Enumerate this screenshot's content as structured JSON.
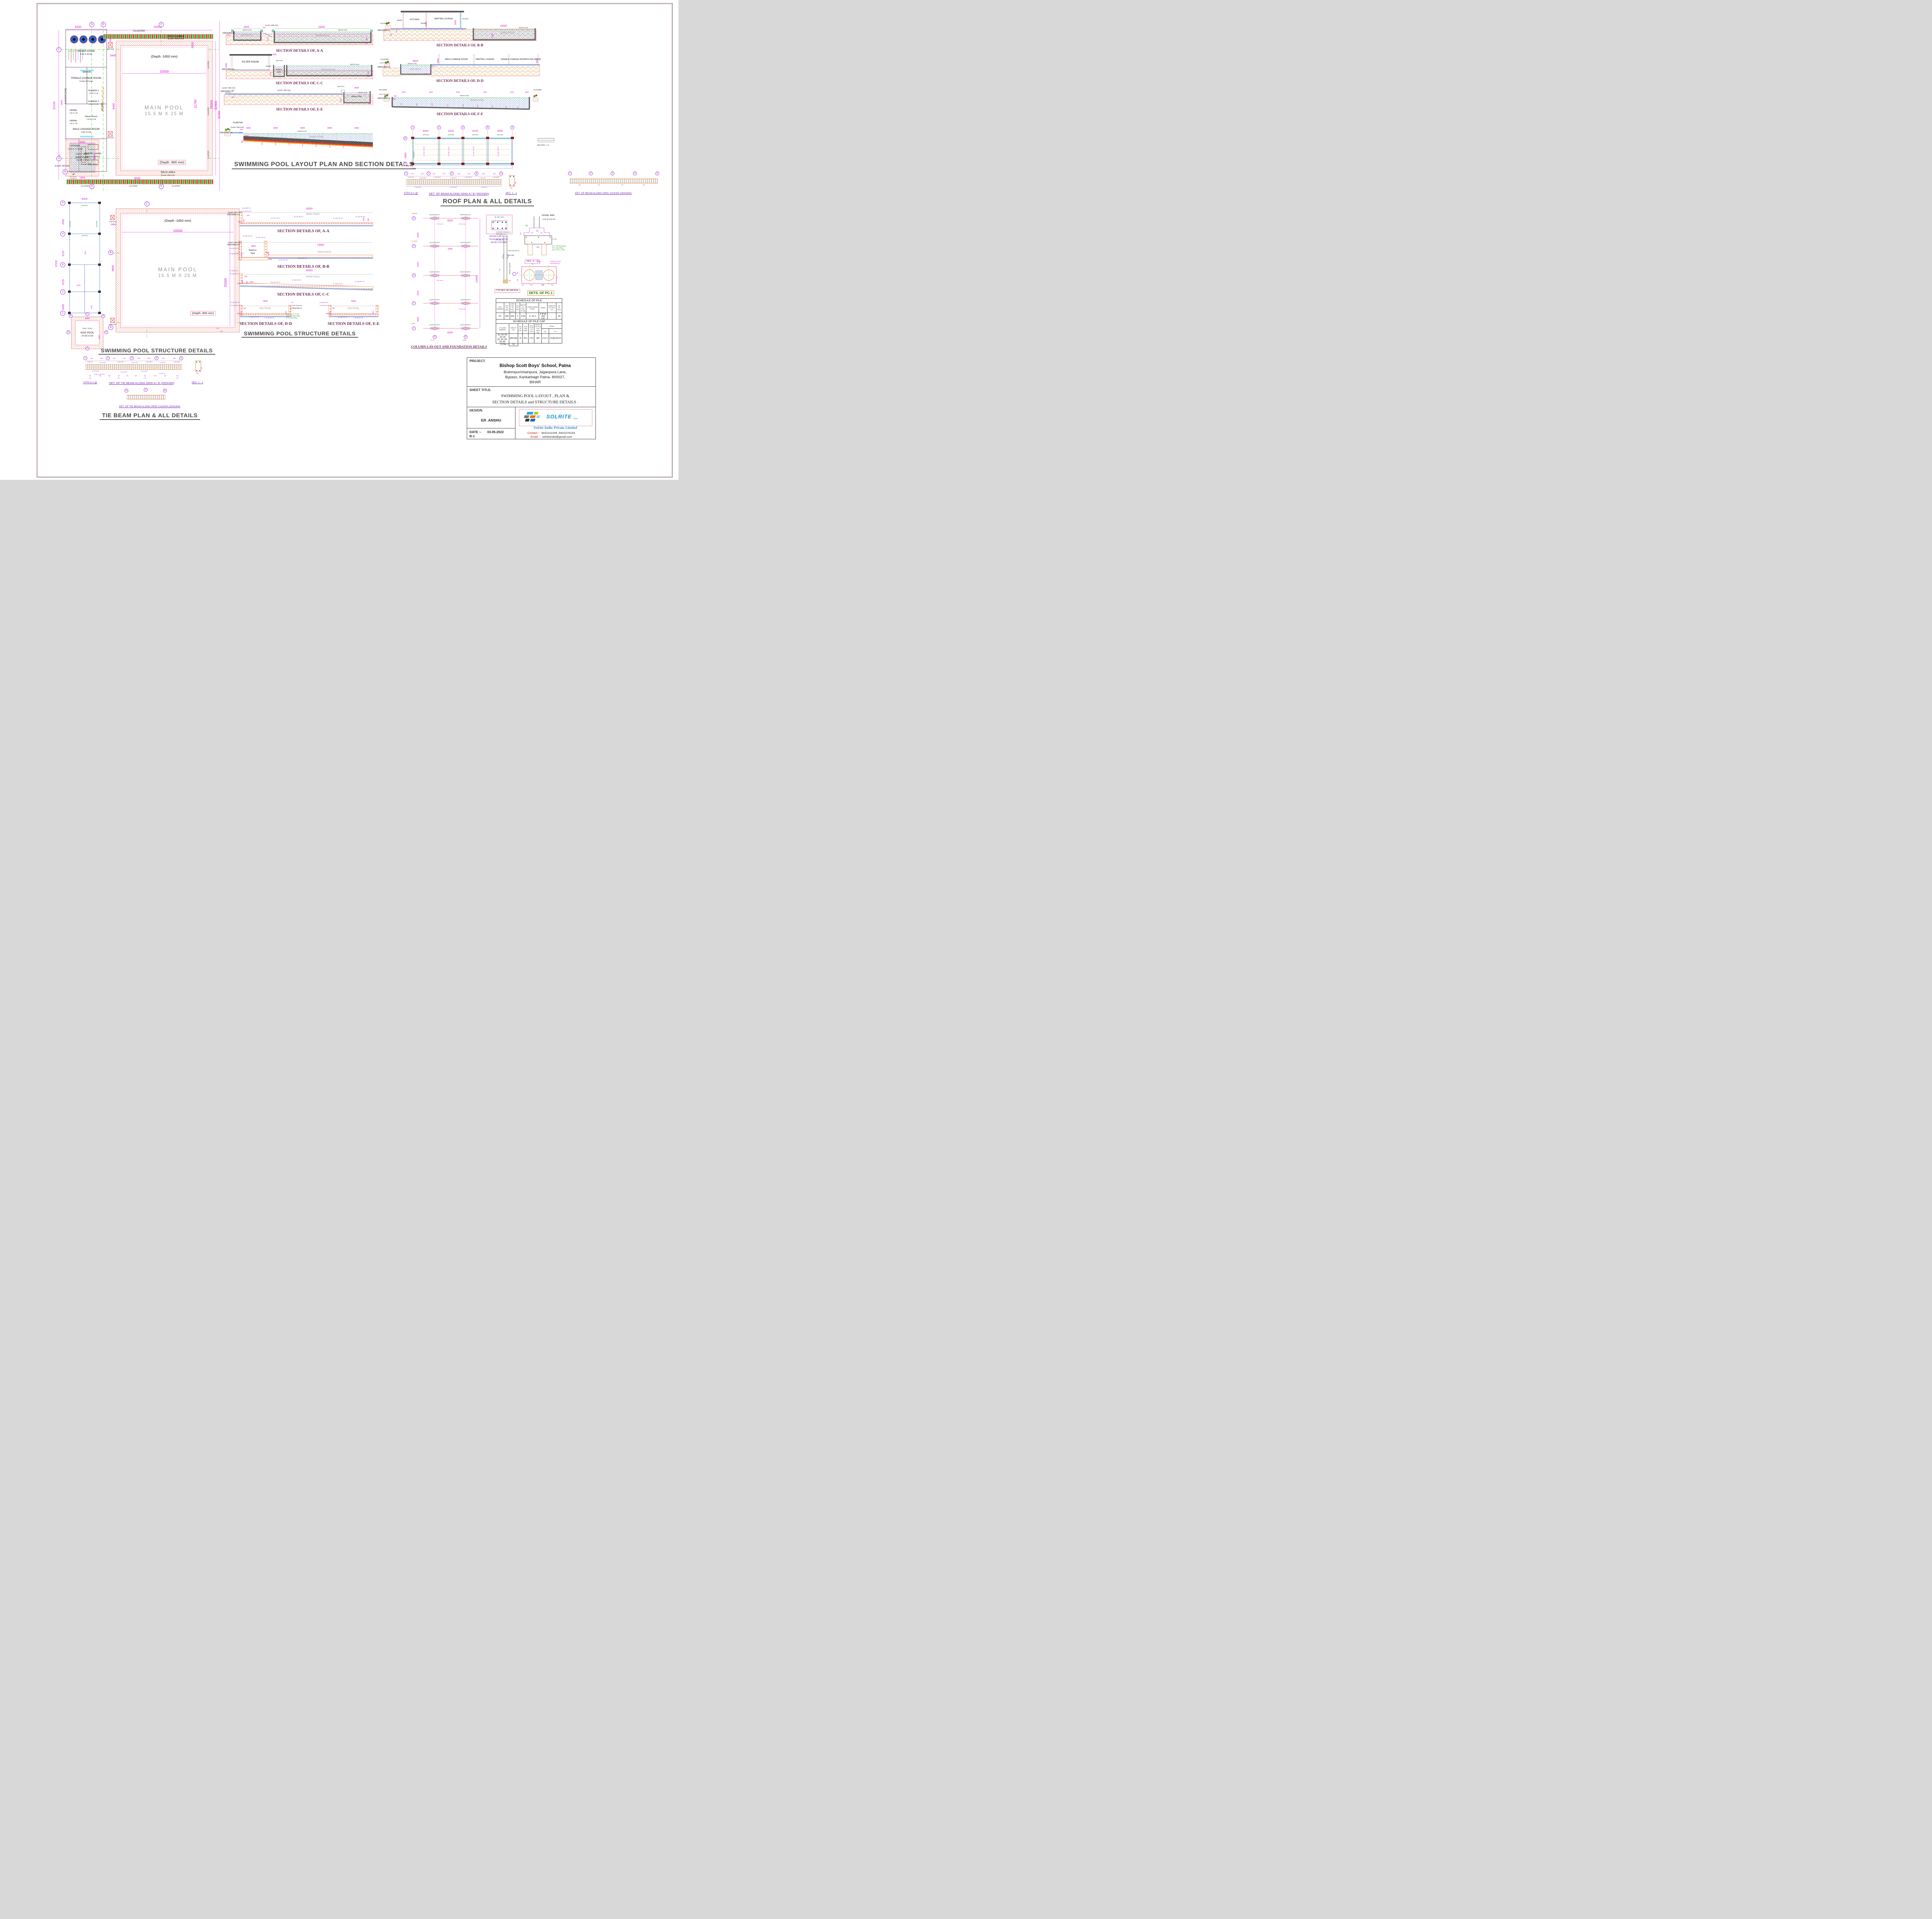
{
  "titles": {
    "layout": "SWIMMING POOL LAYOUT PLAN AND SECTION DETAILS",
    "roof": "ROOF  PLAN & ALL DETAILS",
    "structure_plan": "SWIMMING POOL STRUCTURE  DETAILS",
    "structure_sections": "SWIMMING POOL STRUCTURE  DETAILS",
    "tie": "TIE BEAM  PLAN & ALL DETAILS",
    "column": "COLUMN  LAY-OUT AND FOUNDATION DETAILS"
  },
  "plan": {
    "bub": {
      "d": "D",
      "e": "E",
      "f": "F",
      "c": "C",
      "b": "B",
      "a": "A"
    },
    "dims": {
      "d6250": "6250",
      "d22200": "22200",
      "d15500": "15500",
      "d11700": "11700",
      "d25000": "25000",
      "d32400": "32400",
      "d3000": "3000",
      "d2400": "2400",
      "d9400": "9400",
      "d1800": "1800",
      "d4500": "4500",
      "d1200": "1200",
      "d6000": "6000",
      "d22100": "22100",
      "d200": "200",
      "d300": "300"
    },
    "planter": "PLANTER",
    "plaster": "PLASTER",
    "deck": "DECK AREA",
    "lv600": "(Level +600 mm)",
    "filter": "FILTER ROOM",
    "filter_sz": "6 M X 4.5 M",
    "manhole": "MAN HOLE",
    "mirror": "MIRROR",
    "female": "FEMALE  CHANGE  ROOM",
    "female_sz": "6 mm  X  6 mm",
    "shower": "SHOWER  ZONE",
    "ch1": "CHANGE-1",
    "ch1_sz": "1.6 M X 1 M",
    "ch2": "CHANGE-2",
    "urinal": "URINAL",
    "urinal_sz": "1 M X 1 M",
    "locker": "LOCKER",
    "steam": "Steam  Room",
    "steam_sz": "1.5 M X 2 M",
    "male": "MALE  CHANGE  ROOM",
    "male_sz": "6 M X 6 M",
    "kitchen": "KITCHEN",
    "kitchen_sz": "2.275 M X 4.975 M",
    "wait": "WAITING  LOUNG",
    "wait_sz": "3.675 M X 4.975 M",
    "lv450": "(Level +450 mm)",
    "lv00": "(Level +00 mm)",
    "up": "UP",
    "main": "MAIN  POOL",
    "main_sz": "15.5  M  X  25  M",
    "depth1650": "(Depth -1650 mm)",
    "depth900": "(Depth -900 mm)",
    "kids": "KIDS POOL",
    "kids_sz": "4.5 M X 6 M",
    "depth750": "(Depth -750mm)"
  },
  "sec": {
    "gl": "GROUND LV.",
    "wl": "WATER LEVEL",
    "lv500": "(Level +500 mm)",
    "lv600": "(Level +600 mm)",
    "aa": {
      "cap": "SECTION DETAILS OF, A-A",
      "kids": "KIDS POOL",
      "main": "MAIN  POOL",
      "d4500": "4500",
      "d250": "250",
      "d15500": "15500",
      "d600": "600",
      "d750": "750",
      "d3150": "3150",
      "d900": "900",
      "d300": "300"
    },
    "cc": {
      "cap": "SECTION DETAILS OF, C-C",
      "filter": "FILTER ROOM",
      "door": "DOOR",
      "mh": "MAN HOLE",
      "bt1": "Balance",
      "bt2": "Tank",
      "main": "MAIN  POOL",
      "d3000": "3000",
      "d600": "600",
      "d1200": "1200",
      "d1650": "1650",
      "d300": "300"
    },
    "ee": {
      "cap": "SECTION DETAILS OF, E-E",
      "mh": "MAN HOLE",
      "bt": "Balance Tank",
      "d150": "150",
      "d300": "300",
      "d3600": "3600",
      "d1200": "1200",
      "d1500": "1500",
      "d32400": "32400"
    },
    "long": {
      "planter": "PLANTER",
      "main": "MAIN  POOL",
      "d3000": "3000",
      "d300": "300",
      "d200": "200",
      "d1000": "1000",
      "d900": "900",
      "depths": [
        "1515",
        "1609",
        "1715",
        "1811",
        "1898",
        "2001",
        "2114"
      ]
    },
    "bb": {
      "cap": "SECTION DETAILS OF, B-B",
      "kitchen": "KITCHEN",
      "wait": "WAITING LOUNGE",
      "door": "DOOR",
      "glass": "GLASS",
      "main": "MAIN  POOL",
      "planter": "PLANTER",
      "d2100": "2100",
      "d3000": "3000",
      "d50": "50",
      "d15500": "15500",
      "d1300": "1300",
      "d950": "950",
      "d416": "416.6"
    },
    "dd": {
      "cap": "SECTION DETAILS OF, D-D",
      "male": "MALE CHANGE ROOM",
      "wait": "WAITING LOUNGE",
      "female": "FEMALE CHANGE ROOM",
      "filter": "FILTER ROOM",
      "kids": "KIDS POOL",
      "planter": "PLANTER",
      "d4500": "4500",
      "d3000": "3000",
      "d750": "750",
      "d300": "300",
      "d200": "200"
    },
    "ff": {
      "cap": "SECTION DETAILS OF, F-F",
      "main": "MAIN  POOL",
      "planter": "PLANTER",
      "d3000": "3000",
      "d1000": "1000",
      "d300": "300",
      "d200": "200",
      "depths": [
        "900",
        "965",
        "1083",
        "1161",
        "1259",
        "1355",
        "1454",
        "1552",
        "1000"
      ]
    }
  },
  "roof": {
    "grid": [
      "1",
      "2",
      "3",
      "4",
      "5"
    ],
    "gdims": [
      "6000",
      "5226",
      "6125",
      "4500"
    ],
    "ab": [
      "A",
      "B"
    ],
    "d6000": "6000",
    "beam": "(250X450)",
    "reb1": "10 # @ 175 C/C",
    "reb2": "10 # @ 150 C/C",
    "d600": "600",
    "secaa": "SECTION - A-A",
    "det1": "DET. OF  BEAM ALONG GRID A / B  (250X400)",
    "det2": "DET. OF  BEAM ALONG GRID 1/2/3/4/5  (250X400)",
    "sec11": "SEC. 1 - 1",
    "stps": "STPS 8 # @",
    "bdims": [
      "2000",
      "2000",
      "1750",
      "1750",
      "2050",
      "2050",
      "1500",
      "1500"
    ],
    "breb": [
      "2-16 # TH.",
      "1-20 # EXT.",
      "1-16 # EXT.",
      "2-16 # TH.",
      "1-20 # EXT.",
      "2-16 # TH.",
      "1-16 # EXT."
    ],
    "brebb": [
      "2-16 # EXT.",
      "2-16 # EXT.",
      "3-16 # TH."
    ],
    "spc": [
      "150",
      "200",
      "150",
      "175",
      "225",
      "175",
      "150",
      "200",
      "150",
      "150"
    ],
    "cc": "C/C",
    "d450": "450",
    "d250": "250"
  },
  "splan": {
    "grid": [
      "5",
      "4",
      "3",
      "2",
      "1"
    ],
    "vdims": [
      "4500",
      "6125",
      "5226",
      "6000"
    ],
    "total": "22100",
    "top": "6000",
    "beam": "(250X400)",
    "i2200": "2200",
    "i4976": "4976",
    "i5750": "5750",
    "mh": "MAN HOLE",
    "d2400": "2400",
    "d9600": "9600",
    "d15500": "15500",
    "d25000": "25000",
    "d200": "200",
    "d300": "300",
    "main": "MAIN  POOL",
    "main_sz": "15.5  M  X  25  M",
    "depth1650": "(Depth -1650 mm)",
    "depth900": "(Depth -900 mm)",
    "kids": "KIDS POOL",
    "kids_sz": "4.5 M X 6 M",
    "depth750": "(Depth -750mm)",
    "k4500": "4500",
    "k6000": "6000",
    "bub": {
      "c": "C",
      "b": "B",
      "a": "A",
      "d": "D",
      "e": "E"
    }
  },
  "ss": {
    "gl": "GROUND LV.",
    "lv600": "(Level +600 mm)",
    "r8150": "8 # @ 150 C/C",
    "r10150": "10 # @ 150 C/C",
    "r12175": "12 # @ 175 C/C",
    "r10200": "10 # @ 200 C/C",
    "r8200": "8 # @ 200 C/C",
    "r10175": "10 # @ 175 C/C",
    "aa": {
      "cap": "SECTION DETAILS OF, A-A",
      "main": "MAIN  POOL",
      "d15500": "15500",
      "d900": "900",
      "d1800": "1800",
      "d450": "450",
      "d300": "300",
      "d150": "150"
    },
    "bb": {
      "cap": "SECTION DETAILS OF, B-B",
      "bt1": "Balance",
      "bt2": "Tank",
      "main": "MAIN  POOL",
      "d15500": "15500",
      "d4800": "4800",
      "d1500": "1500",
      "d600": "600",
      "d450": "450",
      "d150": "150"
    },
    "cc": {
      "cap": "SECTION DETAILS OF, C-C",
      "main": "MAIN  POOL",
      "d25000": "25000",
      "d1000": "1000",
      "d900": "900",
      "d450": "450",
      "d300": "300",
      "d150": "150"
    },
    "dd": {
      "cap": "SECTION DETAILS OF, D-D",
      "pool": "KID  POOL",
      "d4500": "4500",
      "d125": "125",
      "d250": "250",
      "d750": "750",
      "d300": "300",
      "d450": "450",
      "d150": "150",
      "n1": "100 Th. P.C.C. (1:3:6)",
      "n2": "75 Th. Flat Brick Soling",
      "n3": "75 Th. Sand Filling"
    },
    "ee": {
      "cap": "SECTION DETAILS OF, E-E",
      "pool": "KID  POOL",
      "d6000": "6000",
      "d750": "750",
      "d300": "300",
      "d450": "450",
      "d150": "150"
    }
  },
  "col": {
    "levels": {
      "l5": "+21875",
      "l4": "+17375",
      "l1": "+000"
    },
    "grid": [
      "5",
      "4",
      "3",
      "2",
      "1"
    ],
    "cols": [
      "A5(250X400)PC1",
      "B5(250X400)PC1",
      "A4(250X400)PC1",
      "B4(250X400)PC1",
      "A3(250X400)PC1",
      "B3(250X400)PC1",
      "A2(250X400)PC1",
      "B2(250X400)PC1",
      "A1(250X400)PC1",
      "B1(250X400)PC1"
    ],
    "note": "75 ℄ of col.",
    "d6000": "6000",
    "d21849": "21849",
    "vdims": [
      "4500",
      "6125",
      "5226",
      "6000"
    ],
    "ab": [
      "A",
      "B"
    ],
    "a0": "+0'-0\"",
    "b0": "+000"
  },
  "det": {
    "tor": "8-16 Tor",
    "torl1": "DETAILS OF A1,A2,",
    "torl2": "A3,A4,A5,B1,B2,B3,",
    "torl3": "B4,B5 COLUMN",
    "dowel": "DOWEL BAR",
    "tor100": "8 Tor @ 100 C/C",
    "g": "(g)",
    "h": "(h)",
    "d450": "450",
    "d200": "200",
    "t38": "3 - 8 Tor",
    "d900": "900",
    "n75a": "75 Th. Flat Brick Soling",
    "n75b": "75 Th. Sand Filling",
    "n100": "100 Th. P.C.C. (1:3:6)",
    "egl1": "EXISTING GROUND LV",
    "egl2": "(ORIGINAL G.L.)",
    "cutoff": "CUT OFF LV.",
    "mm6": "6 mm Ø @ 200 C/C",
    "mainbar": "MAIN BAR",
    "bucket": "BUCKET LENGTH",
    "d600": "600",
    "typpile": "TYP DET. OF U/R PILE",
    "secpp": "SEC.   P - P",
    "pc1": "DETS.  OF  PC-1",
    "ped1": "PEDESTAL SIDE",
    "ped2": "(600X600X200)",
    "d1400": "1400",
    "d300": "300",
    "d250": "250"
  },
  "pile": {
    "title": "SCHEDULE   OF   PILE",
    "h": [
      "PILE MARKED",
      "PILE DIA (mm)",
      "U/R DIA OF PILE (mm)",
      "NO OF U/R",
      "DEPTH OF PILE 'D' (M)",
      "LONGITUDINAL STEEL",
      "RINGS",
      "CAPACITY OF PILE (T)",
      "NO OF PILE"
    ],
    "r": [
      "P1",
      "300",
      "600",
      "2",
      "4.50",
      "5 -10 #",
      "6 Ø @ 200 C/C",
      "-",
      "20"
    ],
    "total_l": "TOTAL =",
    "total": "20"
  },
  "cap": {
    "title": "SCHEDULE  OF  PILE  CAP",
    "h": [
      "COLUMN  MARKED",
      "SIZE OF COL.",
      "NO OF COL.",
      "PILE CAP MKD.",
      "NO & TYPE OF PILE",
      "DEPTH OF PILE CAP (mm) (D)"
    ],
    "steel": "STEEL",
    "hg": "( g )",
    "hh": "( h )",
    "r1a": "A1, A2, A3 ,A4, A5",
    "r1b": "B1, B2, B3, B4, B5",
    "r": [
      "250X400",
      "10",
      "PC1",
      "2 P1",
      "400",
      "6-12 #",
      "12#@125C/C"
    ],
    "total_l": "TOTAL =",
    "total": "10"
  },
  "tie": {
    "det1": "DET. OF  TIE BEAM ALONG GRID A / B  (250X400)",
    "det2": "DET. OF  TIE BEAM ALONG GRID 1/2/3/4/5  (250X400)",
    "stps": "STPS 8 # @",
    "sec11": "SEC. 1 - 1",
    "grid": [
      "1",
      "2",
      "3",
      "4",
      "5"
    ],
    "dims": [
      "2000",
      "2000",
      "1750",
      "1750",
      "2050",
      "2050",
      "1500",
      "1500"
    ],
    "reb": [
      "2-12# TH.",
      "1-16 # EXT.",
      "1-16 # EXT.",
      "2-12 # TH.",
      "1-20 # EXT.",
      "2-12# TH.",
      "1-16 # EXT."
    ],
    "rebb": [
      "2-12 # EXT.",
      "2-16 # EXT.",
      "2-12 # EXT.",
      "2-12# +1-16 # TH.",
      "3-16 # TH."
    ],
    "spc": [
      "150",
      "200",
      "150",
      "175",
      "225",
      "175",
      "150",
      "200",
      "150",
      "150"
    ],
    "cc": "C/C",
    "d450": "450",
    "d250": "250",
    "ab": [
      "A",
      "B"
    ]
  },
  "tb": {
    "project_l": "PROJECT.",
    "name": "Bishop Scott Boys' School, Patna",
    "addr1": "Brahmpur/chainpura, Jaganpura Lane,",
    "addr2": "Bypass, Kankarbagh Patna- 800027,",
    "addr3": "BIHAR",
    "sheet_l": "SHEET TITLE.",
    "st1": "SWIMMING POOL LAYOUT ,  PLAN &",
    "st2": "SECTION DETAILS and STRUCTURE DETAILS .",
    "design_l": "DESIGN.",
    "designer": "ER .ANSHU",
    "date_l": "DATE :-",
    "date": "03.05.2022",
    "rev": "R-1",
    "brand": "SOLRITE",
    "brand2": "INDIA",
    "script": "Solrite India Private Limited",
    "contact_l": "Contact :-",
    "contact": "9431011006 ,9431076164",
    "email_l": "Email :-",
    "email": "solriteindia@gmail.com"
  }
}
